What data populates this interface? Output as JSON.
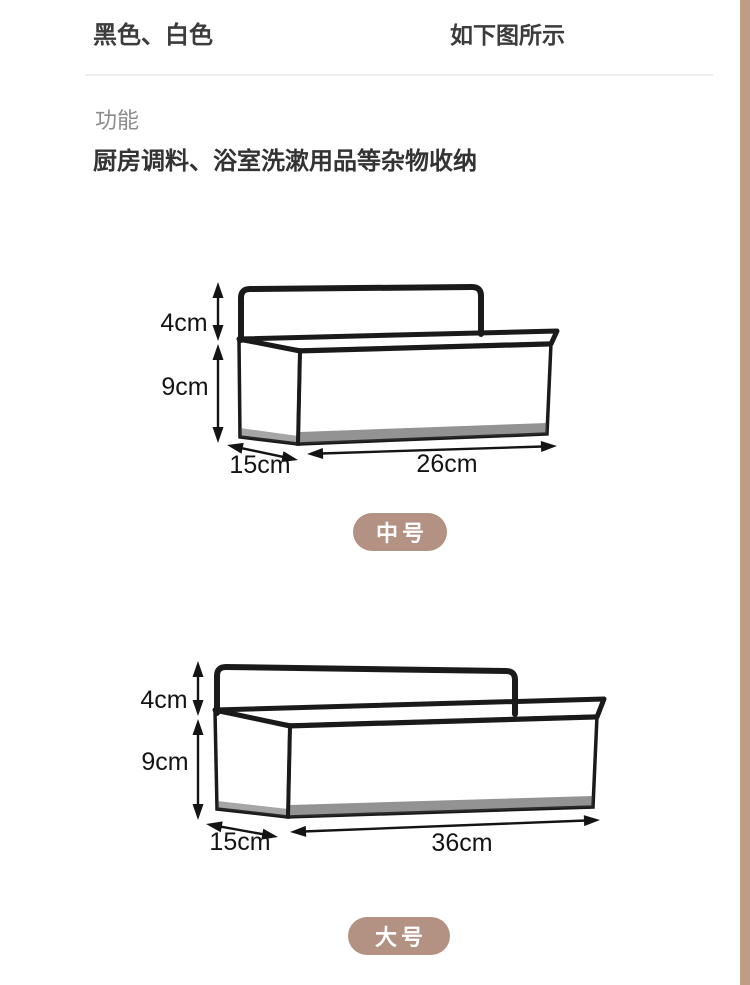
{
  "header": {
    "color_options": "黑色、白色",
    "picture_note": "如下图所示"
  },
  "section": {
    "label": "功能",
    "description": "厨房调料、浴室洗漱用品等杂物收纳"
  },
  "products": [
    {
      "name": "中号",
      "handle_height": "4cm",
      "basket_height": "9cm",
      "depth": "15cm",
      "width": "26cm"
    },
    {
      "name": "大号",
      "handle_height": "4cm",
      "basket_height": "9cm",
      "depth": "15cm",
      "width": "36cm"
    }
  ],
  "colors": {
    "badge_bg": "#b39183",
    "badge_text": "#ffffff",
    "wire_black": "#1a1a1a",
    "dimension_text": "#141414",
    "divider": "#eeeeee",
    "section_label_gray": "#8c8c8c",
    "heading_text": "#3c3c3c",
    "right_edge_strip": "#c09c83"
  }
}
